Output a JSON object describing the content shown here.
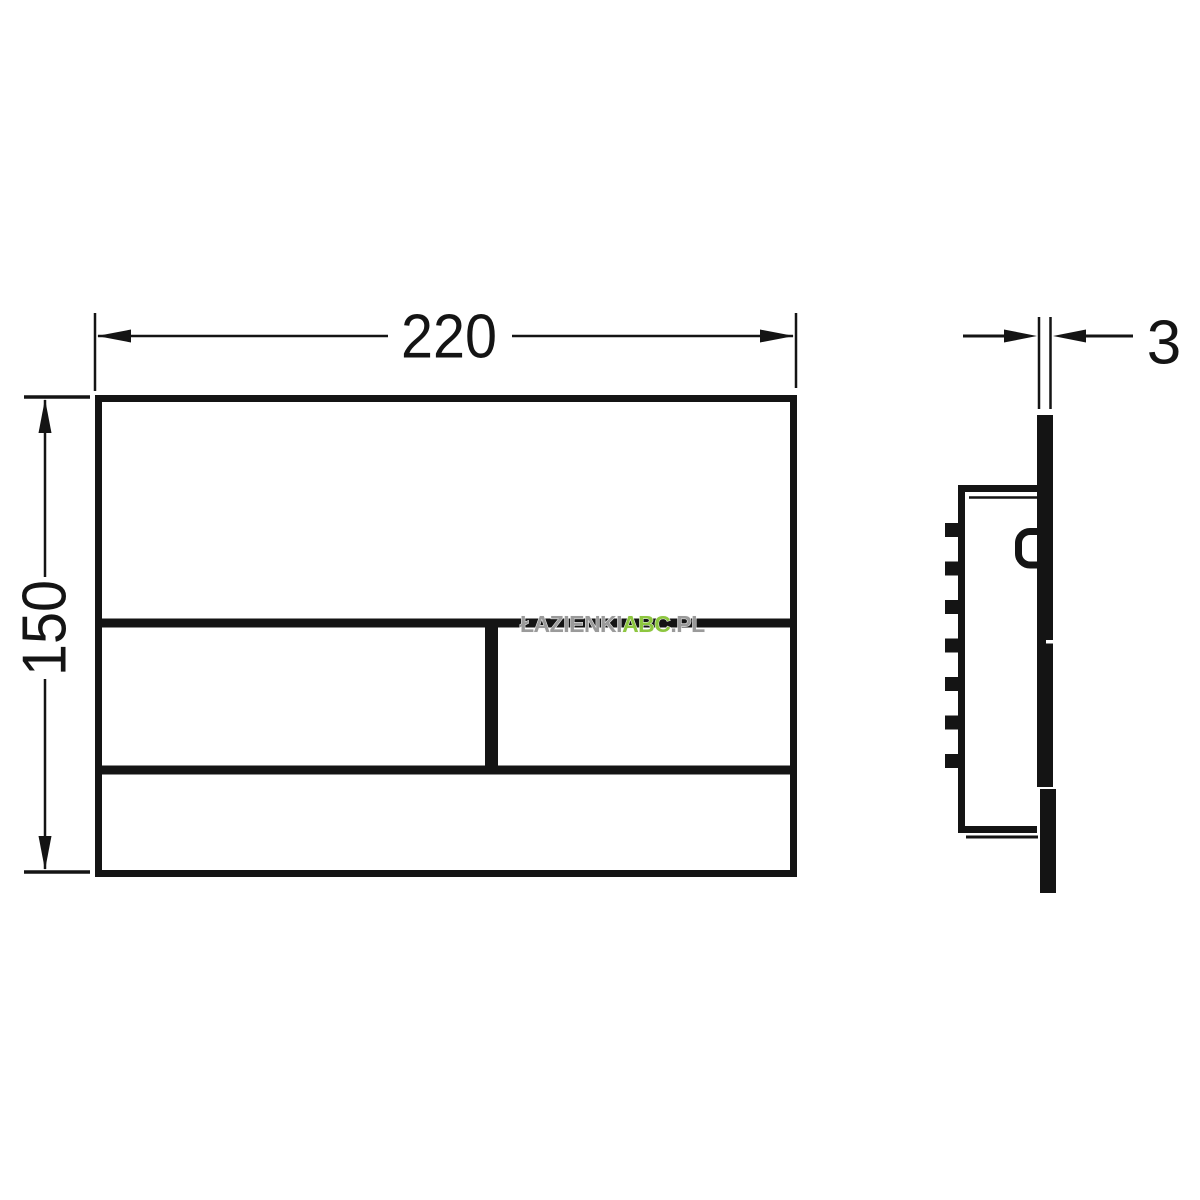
{
  "drawing": {
    "type": "technical-dimension-drawing",
    "line_color": "#141414",
    "background": "#ffffff",
    "views": {
      "front": {
        "width_dim_label": "220",
        "height_dim_label": "150"
      },
      "side": {
        "thickness_dim_label": "3"
      }
    },
    "watermark": {
      "part_gray_left": "ŁAZIENKI",
      "part_green": "ABC",
      "part_gray_right": ".PL",
      "color_gray": "#9a9a9a",
      "color_green": "#8dc63f"
    }
  }
}
